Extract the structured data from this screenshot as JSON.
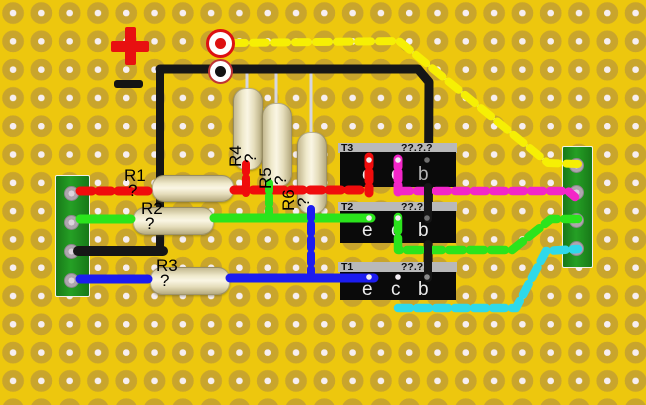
{
  "board": {
    "type": "perfboard-circuit-layout",
    "bg_color": "#edc70e",
    "pad_color": "#c9a52c",
    "hole_color": "#f6eef0"
  },
  "power": {
    "plus_label": "+",
    "minus_label": "−"
  },
  "connectors": {
    "strip_color": "#1f8c1f",
    "left_pins": 4,
    "right_pins": 4
  },
  "resistors": [
    {
      "label": "R1",
      "value": "?"
    },
    {
      "label": "R2",
      "value": "?"
    },
    {
      "label": "R3",
      "value": "?"
    },
    {
      "label": "R4",
      "value": "?"
    },
    {
      "label": "R5",
      "value": "?"
    },
    {
      "label": "R6",
      "value": "?"
    }
  ],
  "transistors": [
    {
      "label": "T3",
      "value": "??.?.?",
      "pins": [
        "e",
        "c",
        "b"
      ]
    },
    {
      "label": "T2",
      "value": "??.?.?",
      "pins": [
        "e",
        "c",
        "b"
      ]
    },
    {
      "label": "T1",
      "value": "??.?.?",
      "pins": [
        "e",
        "c",
        "b"
      ]
    }
  ],
  "wires": {
    "red": "#f00c0c",
    "green": "#2be41c",
    "blue": "#1c1cf0",
    "black": "#161616",
    "pink": "#f326c8",
    "cyan": "#2fd9ea",
    "yellow": "#f6ef04",
    "silver": "#d6d6e0"
  }
}
